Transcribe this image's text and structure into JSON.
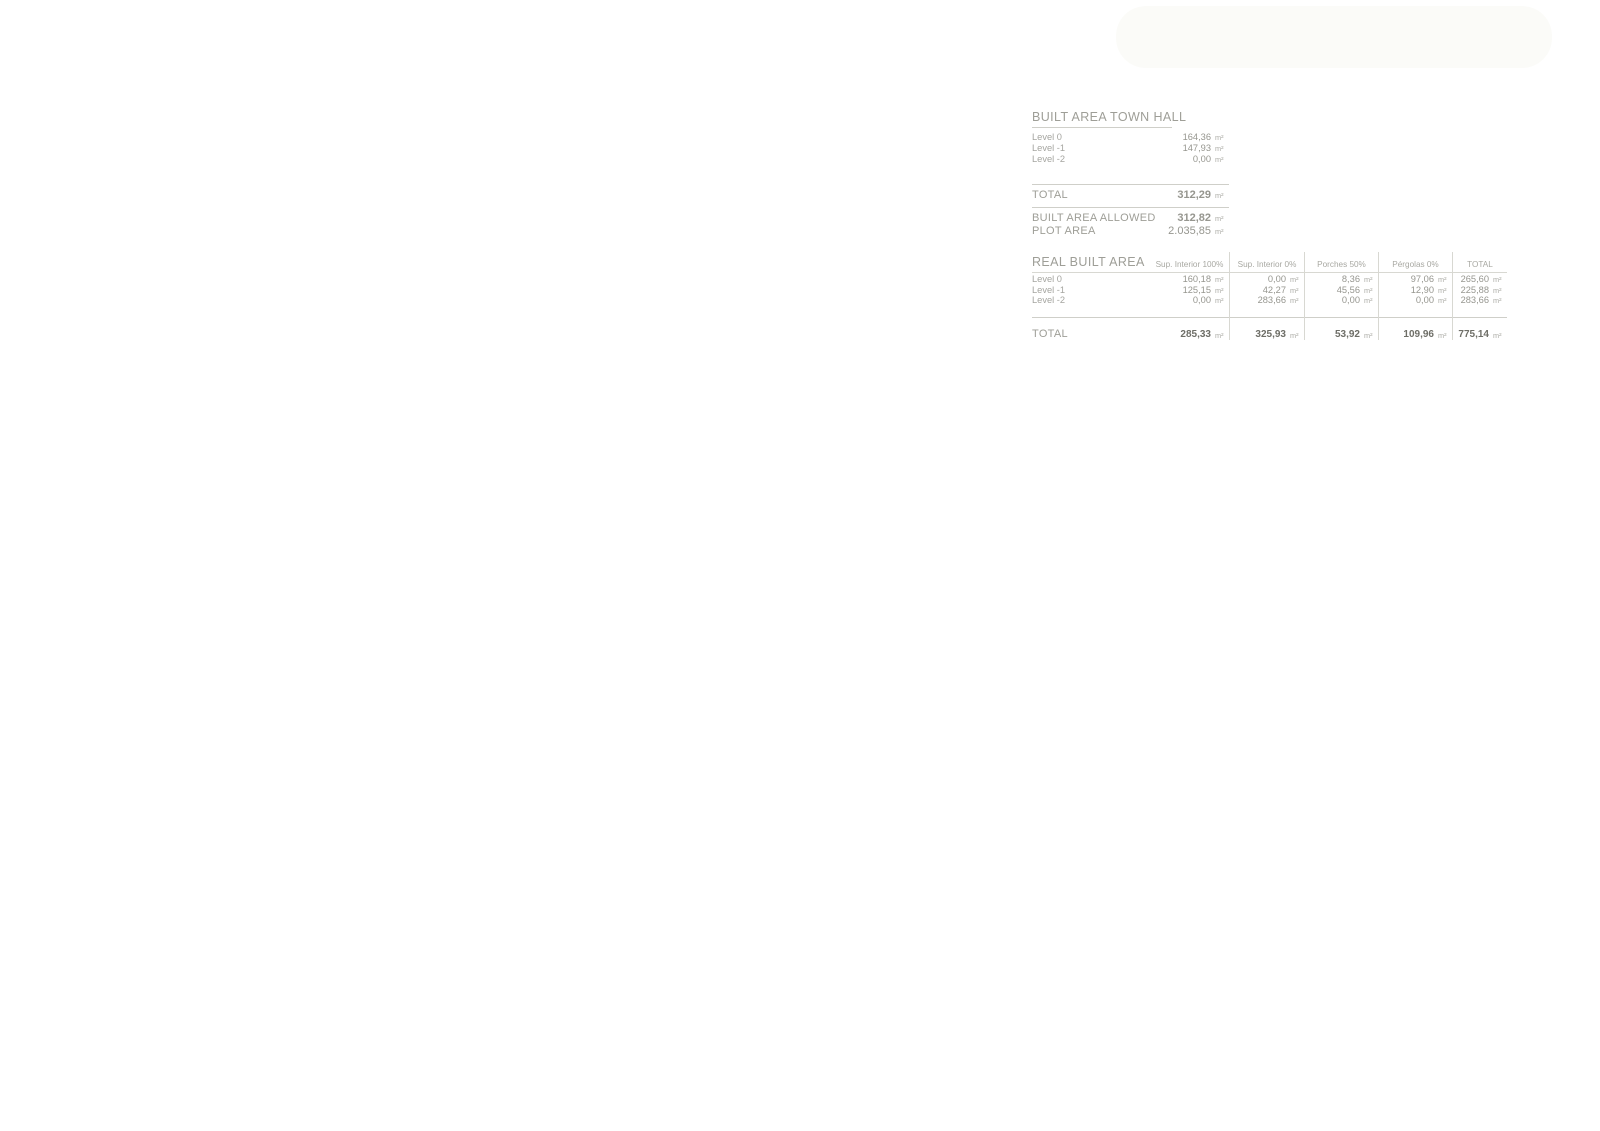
{
  "panel": {
    "unit": "m²",
    "built_area_town_hall": {
      "title": "BUILT AREA TOWN HALL",
      "rows": [
        {
          "label": "Level 0",
          "value": "164,36"
        },
        {
          "label": "Level -1",
          "value": "147,93"
        },
        {
          "label": "Level -2",
          "value": "0,00"
        }
      ],
      "total_label": "TOTAL",
      "total_value": "312,29",
      "allowed_label": "BUILT AREA ALLOWED",
      "allowed_value": "312,82",
      "plot_label": "PLOT AREA",
      "plot_value": "2.035,85"
    },
    "real_built_area": {
      "title": "REAL BUILT AREA",
      "columns": [
        "Sup. Interior 100%",
        "Sup. Interior 0%",
        "Porches 50%",
        "Pérgolas 0%",
        "TOTAL"
      ],
      "rows": [
        {
          "label": "Level 0",
          "values": [
            "160,18",
            "0,00",
            "8,36",
            "97,06",
            "265,60"
          ]
        },
        {
          "label": "Level -1",
          "values": [
            "125,15",
            "42,27",
            "45,56",
            "12,90",
            "225,88"
          ]
        },
        {
          "label": "Level -2",
          "values": [
            "0,00",
            "283,66",
            "0,00",
            "0,00",
            "283,66"
          ]
        }
      ],
      "total_label": "TOTAL",
      "total_values": [
        "285,33",
        "325,93",
        "53,92",
        "109,96",
        "775,14"
      ]
    }
  },
  "plan": {
    "colors": {
      "paper_beige": "#efeee9",
      "road_white": "#ffffff",
      "line_dark": "#26261f",
      "plot_fill": "#f6f6ef",
      "garden_green": "#e3ead5",
      "lawn_green": "#eef2e3",
      "tree_crown": "#a3b383",
      "tree_crown2": "#93a674",
      "tree_branch": "#c89a7e",
      "bush_bright": "#85c43d",
      "bush_dark": "#569421",
      "palm_green": "#3f8f3f",
      "pool_water": "#ccd3d0",
      "wall_gray": "#5c5c5a",
      "paving": "#e9e8e0",
      "neighbor_gray": "#dcdbd6",
      "neighbor_pool": "#d9dedb",
      "label_gray": "#6d6d62",
      "contour_gray": "#7c7c72"
    },
    "labels": [
      {
        "t": "380",
        "x": 424,
        "y": 26,
        "r": 75,
        "k": "c"
      },
      {
        "t": "378",
        "x": 463,
        "y": 38,
        "r": 72,
        "k": "c",
        "s": 5.5
      },
      {
        "t": "376",
        "x": 498,
        "y": 56,
        "r": 72,
        "k": "c",
        "s": 5.5
      },
      {
        "t": "374",
        "x": 532,
        "y": 68,
        "r": 72,
        "k": "c",
        "s": 5.5
      },
      {
        "t": "372",
        "x": 572,
        "y": 80,
        "r": 72,
        "k": "c",
        "s": 5.5
      },
      {
        "t": "371",
        "x": 598,
        "y": 92,
        "r": 72,
        "k": "c",
        "s": 5.5
      },
      {
        "t": "364",
        "x": 686,
        "y": 124,
        "r": 85,
        "k": "c"
      },
      {
        "t": "363",
        "x": 740,
        "y": 250,
        "r": -65,
        "k": "c"
      },
      {
        "t": "362",
        "x": 772,
        "y": 507,
        "r": -78,
        "k": "c"
      },
      {
        "t": "361",
        "x": 892,
        "y": 763,
        "r": -50,
        "k": "c"
      },
      {
        "t": "366",
        "x": 727,
        "y": 906,
        "r": -40,
        "k": "c"
      },
      {
        "t": "364",
        "x": 716,
        "y": 963,
        "r": -35,
        "k": "c",
        "s": 5.5
      },
      {
        "t": "363",
        "x": 705,
        "y": 976,
        "r": -32,
        "k": "c",
        "s": 5.5
      },
      {
        "t": "362",
        "x": 695,
        "y": 988,
        "r": -30,
        "k": "c",
        "s": 5.5
      },
      {
        "t": "361",
        "x": 684,
        "y": 1000,
        "r": -28,
        "k": "c"
      },
      {
        "t": "360",
        "x": 671,
        "y": 1013,
        "r": -26,
        "k": "c"
      },
      {
        "t": "359",
        "x": 657,
        "y": 1026,
        "r": -22,
        "k": "c"
      },
      {
        "t": "360",
        "x": 836,
        "y": 989,
        "r": -78,
        "k": "c"
      },
      {
        "t": "359",
        "x": 700,
        "y": 1082,
        "r": -85,
        "k": "c"
      },
      {
        "t": "358",
        "x": 566,
        "y": 1112,
        "r": -75,
        "k": "c"
      },
      {
        "t": "+374.00",
        "x": 398,
        "y": 238,
        "r": 22
      },
      {
        "t": "+375.00",
        "x": 432,
        "y": 320,
        "r": 22
      },
      {
        "t": "+374.00",
        "x": 408,
        "y": 518,
        "r": 16
      },
      {
        "t": "+372.90",
        "x": 406,
        "y": 600,
        "r": 16
      },
      {
        "t": "+371.86",
        "x": 403,
        "y": 636,
        "r": 16
      },
      {
        "t": "+370.50",
        "x": 406,
        "y": 692,
        "r": 16
      },
      {
        "t": "+369.00",
        "x": 409,
        "y": 739,
        "r": 16
      },
      {
        "t": "+368.00",
        "x": 412,
        "y": 813,
        "r": 14
      },
      {
        "t": "+367.00",
        "x": 410,
        "y": 858,
        "r": 14
      },
      {
        "t": "+366.00",
        "x": 408,
        "y": 895,
        "r": 14
      },
      {
        "t": "+365.00",
        "x": 410,
        "y": 934,
        "r": 14
      },
      {
        "t": "+364.00",
        "x": 408,
        "y": 974,
        "r": 14
      },
      {
        "t": "+363.00",
        "x": 406,
        "y": 1007,
        "r": 10,
        "s": 5.2
      },
      {
        "t": "+362.00",
        "x": 406,
        "y": 1016,
        "r": 10,
        "s": 5.2
      },
      {
        "t": "+361.00",
        "x": 406,
        "y": 1025,
        "r": 10,
        "s": 5.2
      },
      {
        "t": "+360.00",
        "x": 407,
        "y": 1033,
        "r": 10,
        "s": 5.2
      },
      {
        "t": "+359.00",
        "x": 406,
        "y": 1041,
        "r": 10,
        "s": 5.2
      },
      {
        "t": "+358.00",
        "x": 407,
        "y": 1048,
        "r": 10,
        "s": 5.2
      },
      {
        "t": "+374.00",
        "x": 437,
        "y": 508,
        "r": 0
      },
      {
        "t": "+373.00",
        "x": 443,
        "y": 548,
        "r": 0
      },
      {
        "t": "+372.00",
        "x": 440,
        "y": 612,
        "r": 0
      },
      {
        "t": "+371.00",
        "x": 441,
        "y": 676,
        "r": 0
      },
      {
        "t": "+370.00",
        "x": 438,
        "y": 719,
        "r": 0
      },
      {
        "t": "+375.00",
        "x": 489,
        "y": 395,
        "r": 18
      },
      {
        "t": "+374.00",
        "x": 505,
        "y": 163,
        "r": 12
      },
      {
        "t": "+374.00",
        "x": 494,
        "y": 238,
        "r": 12
      },
      {
        "t": "P=14%",
        "x": 481,
        "y": 284,
        "r": 12
      },
      {
        "t": "+374.00",
        "x": 563,
        "y": 240,
        "r": 12
      },
      {
        "t": "+374.00",
        "x": 592,
        "y": 262,
        "r": 12
      },
      {
        "t": "+372.00",
        "x": 608,
        "y": 290,
        "r": 0,
        "s": 5.5
      },
      {
        "t": "+371.00",
        "x": 597,
        "y": 306,
        "r": 0,
        "s": 5.5
      },
      {
        "t": "+370.00",
        "x": 631,
        "y": 306,
        "r": 0,
        "s": 5.5
      },
      {
        "t": "+370.00",
        "x": 652,
        "y": 360,
        "r": 85
      },
      {
        "t": "+369.00",
        "x": 664,
        "y": 417,
        "r": 85
      },
      {
        "t": "+369.00",
        "x": 653,
        "y": 443,
        "r": 0
      },
      {
        "t": "+369.00",
        "x": 669,
        "y": 483,
        "r": 0
      },
      {
        "t": "+374.00",
        "x": 548,
        "y": 437,
        "r": 0
      },
      {
        "t": "+374.00",
        "x": 504,
        "y": 457,
        "r": 0
      },
      {
        "t": "+369.00",
        "x": 704,
        "y": 600,
        "r": 78
      },
      {
        "t": "+374.00",
        "x": 668,
        "y": 623,
        "r": 0
      },
      {
        "t": "+370.50",
        "x": 590,
        "y": 623,
        "r": 0
      },
      {
        "t": "+370.50",
        "x": 646,
        "y": 663,
        "r": 0
      },
      {
        "t": "+370.50",
        "x": 542,
        "y": 672,
        "r": 0
      },
      {
        "t": "+369.00",
        "x": 478,
        "y": 718,
        "r": 0
      },
      {
        "t": "+370.00",
        "x": 527,
        "y": 713,
        "r": 0
      },
      {
        "t": "+370.00",
        "x": 529,
        "y": 741,
        "r": 0
      },
      {
        "t": "+369.00",
        "x": 724,
        "y": 660,
        "r": 0
      },
      {
        "t": "+369.00",
        "x": 736,
        "y": 717,
        "r": 85
      },
      {
        "t": "+370.00 +370.00 +369.80 +369.60 +369.60 +369.40 +369.20 +369.00",
        "x": 645,
        "y": 748,
        "r": 0,
        "s": 4.2
      },
      {
        "t": "+370.00",
        "x": 634,
        "y": 763,
        "r": 0
      },
      {
        "t": "+369.00",
        "x": 524,
        "y": 763,
        "r": 0
      },
      {
        "t": "+369.00",
        "x": 734,
        "y": 777,
        "r": 0,
        "box": 1
      },
      {
        "t": "+368.00",
        "x": 649,
        "y": 843,
        "r": 0
      },
      {
        "t": "+367.00",
        "x": 664,
        "y": 878,
        "r": 0
      }
    ]
  },
  "north": {
    "icon": "north-needle"
  }
}
